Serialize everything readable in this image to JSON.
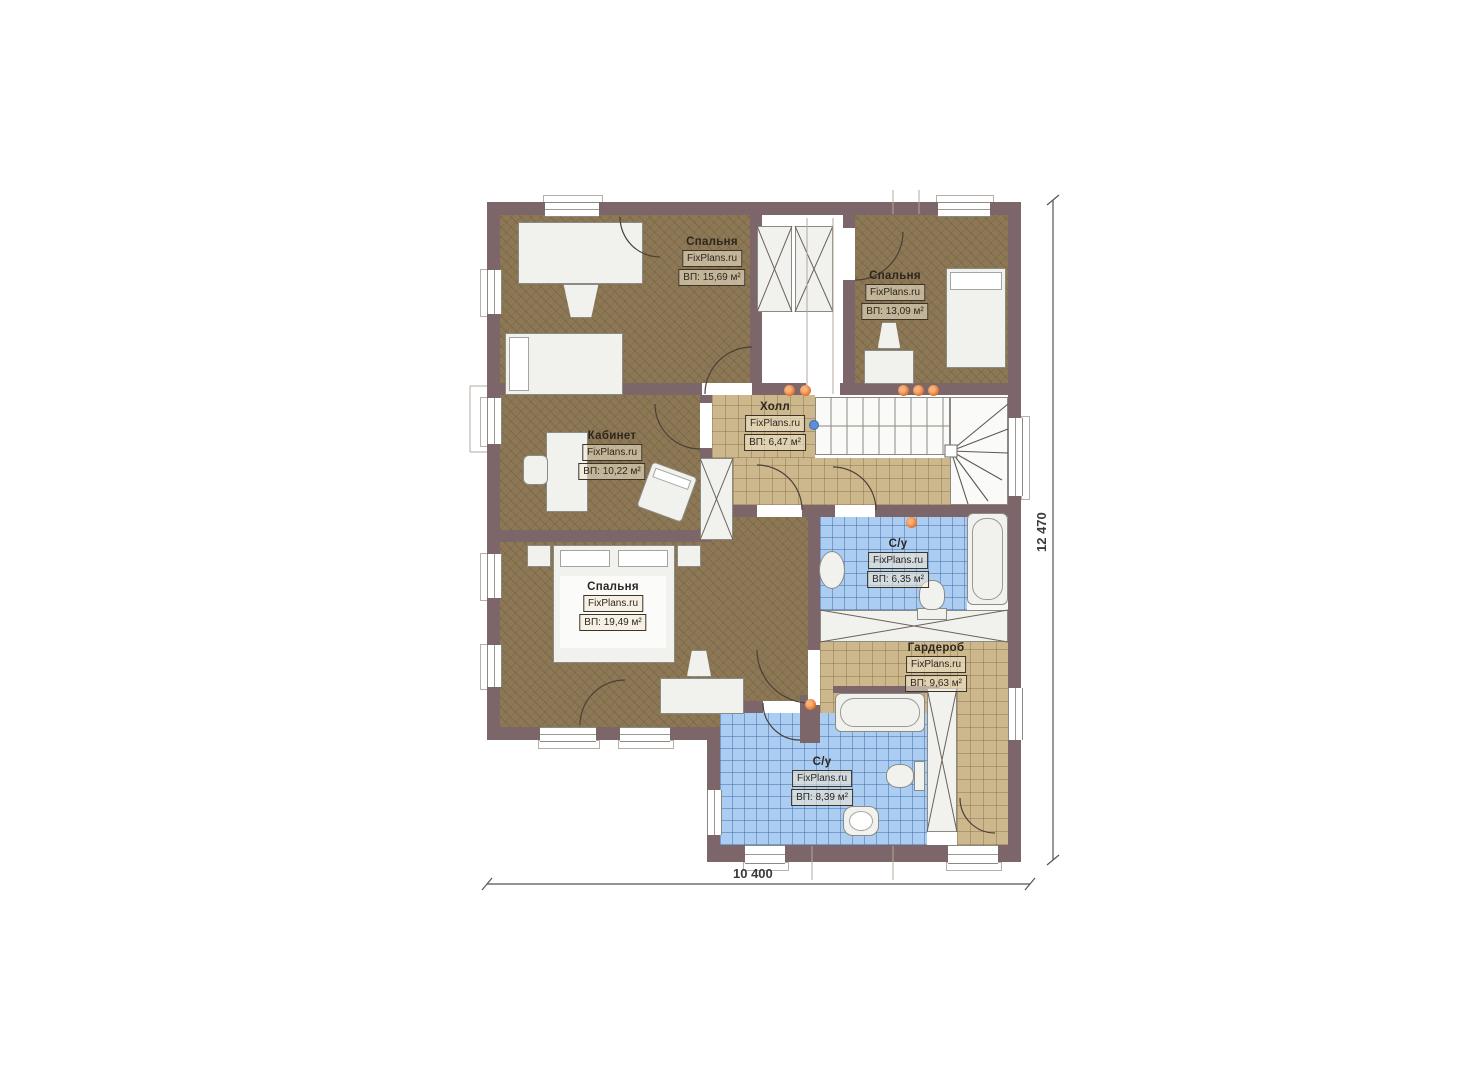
{
  "plan": {
    "brand": "FixPlans.ru",
    "rooms": [
      {
        "key": "bedroom-top-left",
        "name": "Спальня",
        "brand": "FixPlans.ru",
        "area": "ВП: 15,69 м²"
      },
      {
        "key": "bedroom-top-right",
        "name": "Спальня",
        "brand": "FixPlans.ru",
        "area": "ВП: 13,09 м²"
      },
      {
        "key": "hall",
        "name": "Холл",
        "brand": "FixPlans.ru",
        "area": "ВП: 6,47 м²"
      },
      {
        "key": "office",
        "name": "Кабинет",
        "brand": "FixPlans.ru",
        "area": "ВП: 10,22 м²"
      },
      {
        "key": "bathroom-middle",
        "name": "С/у",
        "brand": "FixPlans.ru",
        "area": "ВП: 6,35 м²"
      },
      {
        "key": "wardrobe",
        "name": "Гардероб",
        "brand": "FixPlans.ru",
        "area": "ВП: 9,63 м²"
      },
      {
        "key": "bedroom-master",
        "name": "Спальня",
        "brand": "FixPlans.ru",
        "area": "ВП: 19,49 м²"
      },
      {
        "key": "bathroom-bottom",
        "name": "С/у",
        "brand": "FixPlans.ru",
        "area": "ВП: 8,39 м²"
      }
    ],
    "dimensions": {
      "width_mm": "10 400",
      "height_mm": "12 470"
    },
    "colors": {
      "wall": "#7c666a",
      "wood_floor": "#8d7856",
      "tile_tan": "#cdb88d",
      "tile_blue": "#abcdf1",
      "light_dot": "#e0702a"
    }
  }
}
